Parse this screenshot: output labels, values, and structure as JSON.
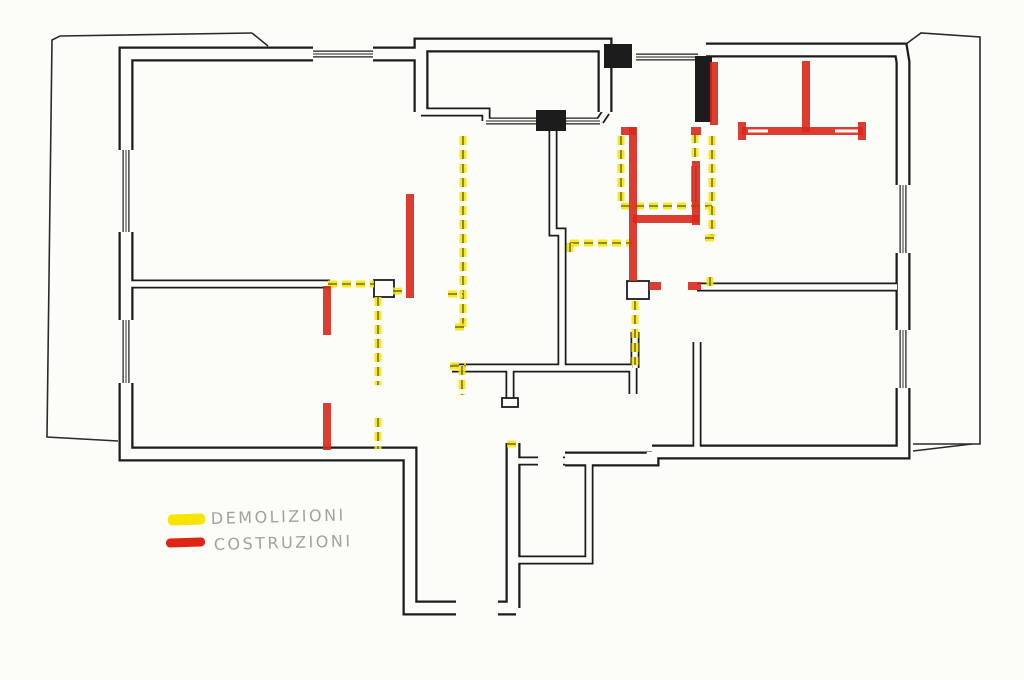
{
  "legend": {
    "items": [
      {
        "key": "demolizioni",
        "label": "DEMOLIZIONI",
        "color": "#f8e400",
        "swatch": [
          168,
          514,
          37,
          11
        ],
        "label_pos": [
          211,
          524
        ]
      },
      {
        "key": "costruzioni",
        "label": "COSTRUZIONI",
        "color": "#df2416",
        "swatch": [
          166,
          538,
          39,
          9
        ],
        "label_pos": [
          214,
          550
        ]
      }
    ]
  },
  "plan": {
    "paper": "#fcfcf9",
    "ink": "#1c1c1c",
    "demolition_color": "#f8e400",
    "construction_color": "#d8281a",
    "boundary_color": "#2a2a2a",
    "outer_walls": [
      [
        [
          313,
          54
        ],
        [
          126,
          54
        ],
        [
          126,
          150
        ]
      ],
      [
        [
          126,
          232
        ],
        [
          126,
          320
        ]
      ],
      [
        [
          126,
          383
        ],
        [
          126,
          454
        ],
        [
          410,
          454
        ],
        [
          410,
          608
        ],
        [
          456,
          608
        ]
      ],
      [
        [
          373,
          54
        ],
        [
          421,
          54
        ]
      ],
      [
        [
          421,
          112
        ],
        [
          421,
          45
        ],
        [
          605,
          45
        ],
        [
          605,
          112
        ]
      ],
      [
        [
          706,
          50
        ],
        [
          901,
          50
        ],
        [
          903,
          62
        ],
        [
          903,
          185
        ]
      ],
      [
        [
          903,
          253
        ],
        [
          903,
          330
        ]
      ],
      [
        [
          903,
          388
        ],
        [
          903,
          452
        ],
        [
          652,
          452
        ]
      ],
      [
        [
          652,
          452
        ],
        [
          652,
          459
        ],
        [
          565,
          459
        ]
      ],
      [
        [
          513,
          443
        ],
        [
          513,
          608
        ]
      ],
      [
        [
          498,
          608
        ],
        [
          516,
          608
        ]
      ]
    ],
    "inner_walls": [
      [
        [
          126,
          284
        ],
        [
          330,
          284
        ]
      ],
      [
        [
          553,
          116
        ],
        [
          553,
          232
        ],
        [
          562,
          232
        ],
        [
          562,
          368
        ]
      ],
      [
        [
          452,
          368
        ],
        [
          632,
          368
        ]
      ],
      [
        [
          510,
          368
        ],
        [
          510,
          400
        ]
      ],
      [
        [
          633,
          368
        ],
        [
          633,
          394
        ]
      ],
      [
        [
          697,
          287
        ],
        [
          897,
          287
        ]
      ],
      [
        [
          697,
          342
        ],
        [
          697,
          452
        ]
      ],
      [
        [
          635,
          332
        ],
        [
          635,
          368
        ]
      ],
      [
        [
          514,
          461
        ],
        [
          538,
          461
        ]
      ],
      [
        [
          563,
          461
        ],
        [
          589,
          461
        ],
        [
          589,
          560
        ],
        [
          514,
          560
        ]
      ],
      [
        [
          421,
          112
        ],
        [
          486,
          112
        ],
        [
          486,
          121
        ]
      ],
      [
        [
          600,
          121
        ],
        [
          606,
          112
        ]
      ]
    ],
    "thin_walls": [
      [
        [
          694,
          166
        ],
        [
          694,
          202
        ]
      ]
    ],
    "windows": [
      [
        [
          313,
          54
        ],
        [
          373,
          54
        ]
      ],
      [
        [
          126,
          150
        ],
        [
          126,
          232
        ]
      ],
      [
        [
          126,
          320
        ],
        [
          126,
          383
        ]
      ],
      [
        [
          486,
          121
        ],
        [
          536,
          121
        ]
      ],
      [
        [
          566,
          121
        ],
        [
          600,
          121
        ]
      ],
      [
        [
          636,
          57
        ],
        [
          698,
          57
        ]
      ],
      [
        [
          903,
          185
        ],
        [
          903,
          253
        ]
      ],
      [
        [
          903,
          330
        ],
        [
          903,
          388
        ]
      ]
    ],
    "solid_blocks": [
      [
        604,
        44,
        28,
        24
      ],
      [
        536,
        110,
        30,
        21
      ],
      [
        695,
        56,
        17,
        66
      ]
    ],
    "outline_blocks": [
      [
        374,
        280,
        20,
        17
      ],
      [
        627,
        281,
        22,
        18
      ],
      [
        502,
        398,
        16,
        9
      ]
    ],
    "boundary": [
      [
        [
          252,
          33
        ],
        [
          60,
          36
        ],
        [
          52,
          40
        ],
        [
          47,
          437
        ],
        [
          118,
          441
        ]
      ],
      [
        [
          252,
          33
        ],
        [
          268,
          46
        ]
      ],
      [
        [
          906,
          44
        ],
        [
          921,
          33
        ],
        [
          980,
          37
        ],
        [
          980,
          444
        ],
        [
          913,
          444
        ]
      ],
      [
        [
          913,
          451
        ],
        [
          972,
          444
        ]
      ]
    ],
    "demolition_marks": [
      [
        [
          463,
          136
        ],
        [
          463,
          327
        ]
      ],
      [
        [
          448,
          294
        ],
        [
          463,
          294
        ]
      ],
      [
        [
          455,
          327
        ],
        [
          468,
          327
        ]
      ],
      [
        [
          328,
          284
        ],
        [
          374,
          284
        ]
      ],
      [
        [
          393,
          291
        ],
        [
          403,
          291
        ]
      ],
      [
        [
          378,
          297
        ],
        [
          378,
          385
        ]
      ],
      [
        [
          378,
          418
        ],
        [
          378,
          449
        ]
      ],
      [
        [
          450,
          366
        ],
        [
          466,
          366
        ]
      ],
      [
        [
          462,
          366
        ],
        [
          462,
          395
        ]
      ],
      [
        [
          507,
          444
        ],
        [
          516,
          444
        ]
      ],
      [
        [
          570,
          243
        ],
        [
          632,
          243
        ]
      ],
      [
        [
          570,
          243
        ],
        [
          570,
          254
        ]
      ],
      [
        [
          621,
          136
        ],
        [
          621,
          206
        ]
      ],
      [
        [
          621,
          206
        ],
        [
          712,
          206
        ]
      ],
      [
        [
          712,
          136
        ],
        [
          712,
          237
        ]
      ],
      [
        [
          705,
          238
        ],
        [
          719,
          238
        ]
      ],
      [
        [
          695,
          134
        ],
        [
          695,
          163
        ]
      ],
      [
        [
          710,
          277
        ],
        [
          710,
          286
        ]
      ],
      [
        [
          635,
          301
        ],
        [
          635,
          365
        ]
      ]
    ],
    "construction_marks": [
      [
        [
          327,
          286
        ],
        [
          327,
          335
        ]
      ],
      [
        [
          327,
          403
        ],
        [
          327,
          450
        ]
      ],
      [
        [
          410,
          194
        ],
        [
          410,
          298
        ]
      ],
      [
        [
          633,
          127
        ],
        [
          633,
          281
        ]
      ],
      [
        [
          621,
          131
        ],
        [
          636,
          131
        ]
      ],
      [
        [
          633,
          219
        ],
        [
          699,
          219
        ]
      ],
      [
        [
          696,
          161
        ],
        [
          696,
          225
        ]
      ],
      [
        [
          649,
          286
        ],
        [
          661,
          286
        ]
      ],
      [
        [
          688,
          286
        ],
        [
          701,
          286
        ]
      ],
      [
        [
          714,
          62
        ],
        [
          714,
          125
        ]
      ],
      [
        [
          806,
          61
        ],
        [
          806,
          132
        ]
      ],
      [
        [
          742,
          131
        ],
        [
          863,
          131
        ]
      ],
      [
        [
          742,
          122
        ],
        [
          742,
          140
        ]
      ],
      [
        [
          862,
          122
        ],
        [
          862,
          140
        ]
      ],
      [
        [
          691,
          131
        ],
        [
          701,
          131
        ]
      ]
    ],
    "white_slits": [
      [
        [
          748,
          131
        ],
        [
          768,
          131
        ]
      ],
      [
        [
          835,
          131
        ],
        [
          858,
          131
        ]
      ]
    ]
  }
}
